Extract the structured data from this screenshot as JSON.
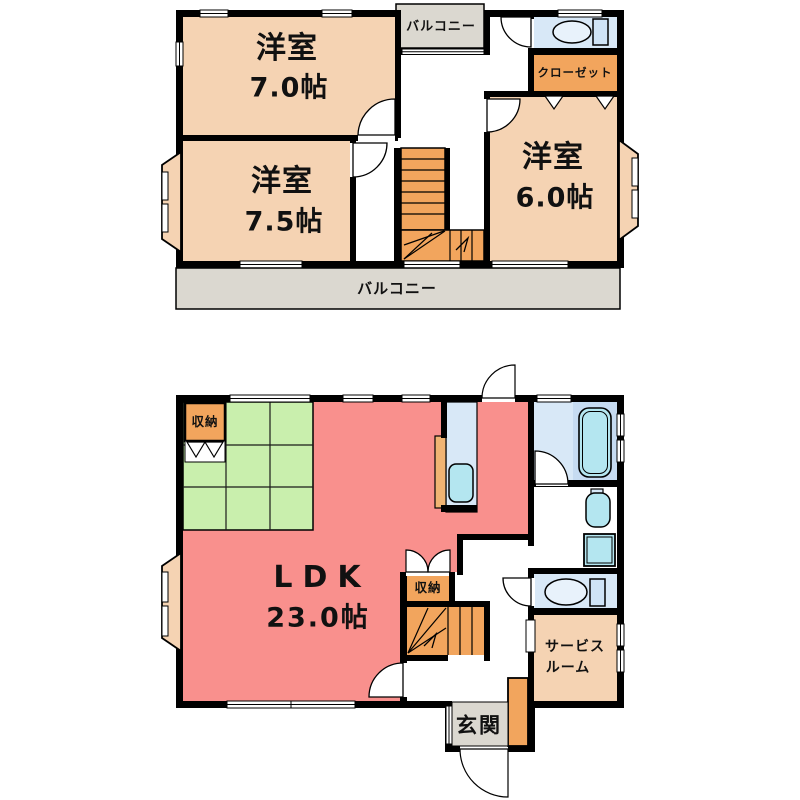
{
  "colors": {
    "wall": "#000000",
    "room_peach": "#f5d3b3",
    "ldk_pink": "#f9908d",
    "tatami_green": "#c9efad",
    "storage_orange": "#f2a55d",
    "balcony_gray": "#dbd8d0",
    "water_blue": "#d8e8f7",
    "bath_blue": "#c6dbf1",
    "fixture_cyan": "#b4e6f0",
    "kitchen_counter": "#f0b473"
  },
  "f2": {
    "room_nw": {
      "name": "洋室",
      "size": "7.0帖"
    },
    "room_sw": {
      "name": "洋室",
      "size": "7.5帖"
    },
    "room_e": {
      "name": "洋室",
      "size": "6.0帖"
    },
    "balcony_top": "バルコニー",
    "balcony_bottom": "バルコニー",
    "closet": "クローゼット"
  },
  "f1": {
    "ldk": {
      "name": "LDK",
      "size": "23.0帖"
    },
    "storage_west": "収納",
    "storage_stairs": "収納",
    "service_room": {
      "line1": "サービス",
      "line2": "ルーム"
    },
    "entrance": "玄関"
  }
}
